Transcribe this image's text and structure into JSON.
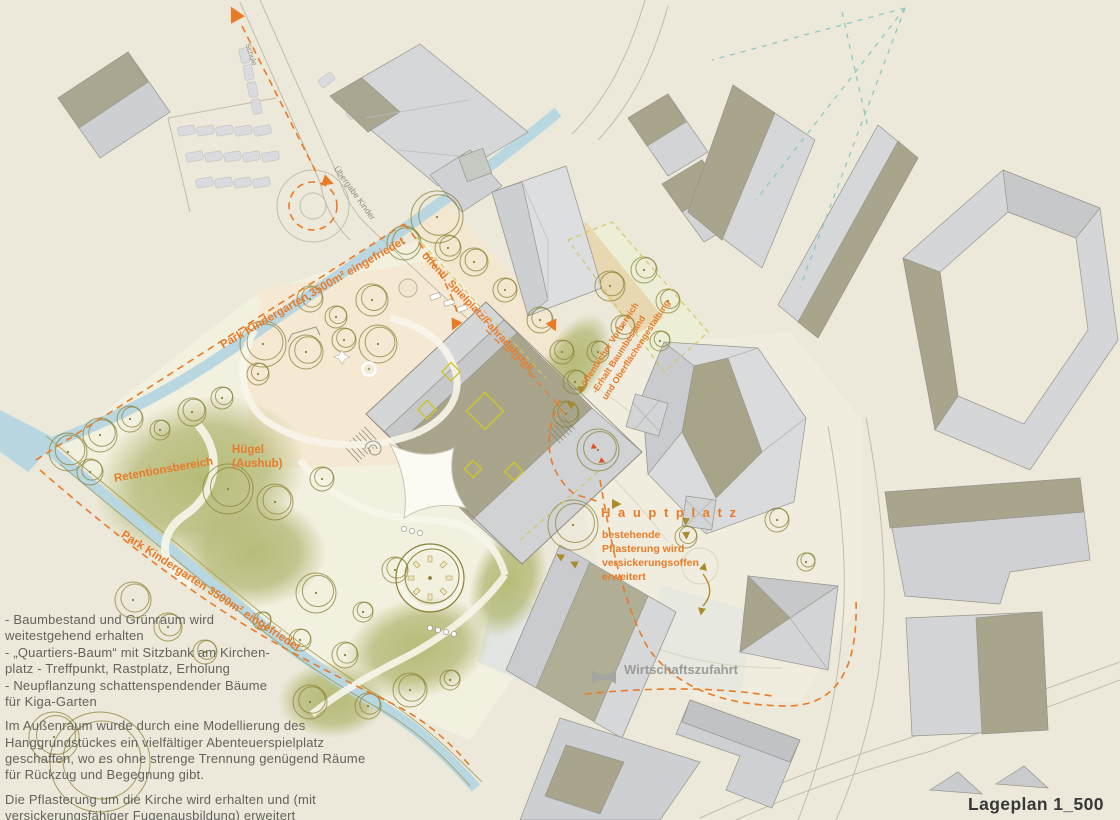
{
  "title": "Lageplan 1_500",
  "map_labels": {
    "park_top": "Park Kindergarten 3500m² eingefriedet",
    "park_bottom": "Park Kindergarten 3500m² eingefriedet",
    "spielplatz": "öffentl. Spielplatz/Fahradabstell...",
    "vorbereich": "öffentlicher Vorbereich\n-Erhalt Baumbestand\nund Oberflächengestaltung",
    "huegel": "Hügel\n(Aushub)",
    "retention": "Retentionsbereich",
    "hauptplatz": "H a u p t p l a t z",
    "hauptplatz_note": "bestehende\nPflasterung wird\nversickerungsoffen\nerweitert",
    "wirtschaftszufahrt": "Wirtschaftszufahrt",
    "schule": "Schule",
    "uebergabe_kinder": "Übergabe Kinder"
  },
  "notes": {
    "para1": "- Baumbestand und Grünraum wird\nweitestgehend erhalten\n- „Quartiers-Baum“ mit Sitzbank am Kirchen-\nplatz - Treffpunkt, Rastplatz, Erholung\n- Neupflanzung schattenspendender Bäume\nfür Kiga-Garten",
    "para2": "Im Außenraum wurde durch eine Modellierung des\nHanggrundstückes ein vielfältiger Abenteuerspielplatz\ngeschaffen, wo es ohne strenge Trennung genügend Räume\nfür Rückzug und Begegnung gibt.",
    "para3": "Die Pflasterung um die Kirche wird erhalten und (mit\nversickerungsfähiger Fugenausbildung) erweitert"
  },
  "colors": {
    "accent_orange": "#e87b28",
    "roof_olive": "#a8a58c",
    "roof_light": "#d5d7d9",
    "stream_blue": "#b9d7e1",
    "teal_dash": "#8fc9c1",
    "park_green": "#b6bb7a",
    "note_text": "#63635c"
  }
}
